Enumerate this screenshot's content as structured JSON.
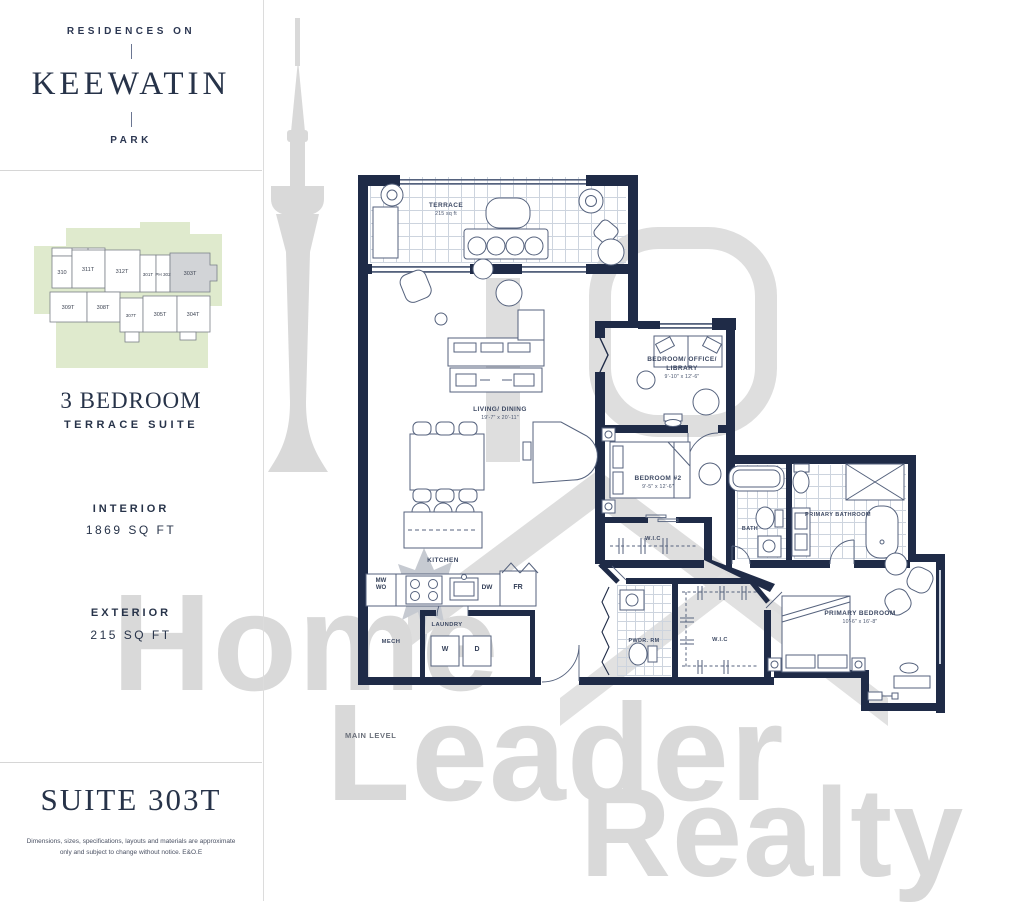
{
  "brand": {
    "top": "RESIDENCES ON",
    "name": "KEEWATIN",
    "bottom": "PARK"
  },
  "keyplan": {
    "units": [
      {
        "label": "310"
      },
      {
        "label": "311T"
      },
      {
        "label": "312T"
      },
      {
        "label": "301T"
      },
      {
        "label": "PH 302"
      },
      {
        "label": "303T"
      },
      {
        "label": "309T"
      },
      {
        "label": "308T"
      },
      {
        "label": "307T"
      },
      {
        "label": "305T"
      },
      {
        "label": "304T"
      }
    ]
  },
  "suite": {
    "type": "3 BEDROOM",
    "subtype": "TERRACE SUITE",
    "interior_label": "INTERIOR",
    "interior_value": "1869 SQ FT",
    "exterior_label": "EXTERIOR",
    "exterior_value": "215 SQ FT",
    "title": "SUITE 303T",
    "disclaimer": "Dimensions, sizes, specifications, layouts and materials are approximate only and subject to change without notice. E&O.E"
  },
  "plan": {
    "level": "MAIN LEVEL",
    "rooms": {
      "terrace": {
        "name": "TERRACE",
        "dims": "215 sq ft"
      },
      "living": {
        "name": "LIVING/ DINING",
        "dims": "19'-7\" x 20'-11\""
      },
      "office": {
        "name": "BEDROOM/ OFFICE/ LIBRARY",
        "dims": "9'-10\" x 12'-6\""
      },
      "bedroom2": {
        "name": "BEDROOM #2",
        "dims": "9'-5\" x 12'-6\""
      },
      "wic2": {
        "name": "W.I.C"
      },
      "bath": {
        "name": "BATH"
      },
      "primary_bath": {
        "name": "PRIMARY BATHROOM"
      },
      "kitchen": {
        "name": "KITCHEN"
      },
      "laundry": {
        "name": "LAUNDRY"
      },
      "mech": {
        "name": "MECH"
      },
      "pwdr": {
        "name": "PWDR. RM"
      },
      "wic_primary": {
        "name": "W.I.C"
      },
      "primary_bedroom": {
        "name": "PRIMARY BEDROOM",
        "dims": "10'-6\" x 16'-8\""
      }
    },
    "appliances": {
      "mw": "MW",
      "wo": "WO",
      "dw": "DW",
      "fr": "FR",
      "washer": "W",
      "dryer": "D"
    }
  },
  "watermark": {
    "line1": "Home",
    "line2": "Leader",
    "line3": "Realty"
  },
  "colors": {
    "navy": "#1f2b47",
    "keyplan_green": "#dfeacd",
    "highlight_gray": "#d2d4d7",
    "watermark_gray": "#d9d9d9"
  }
}
